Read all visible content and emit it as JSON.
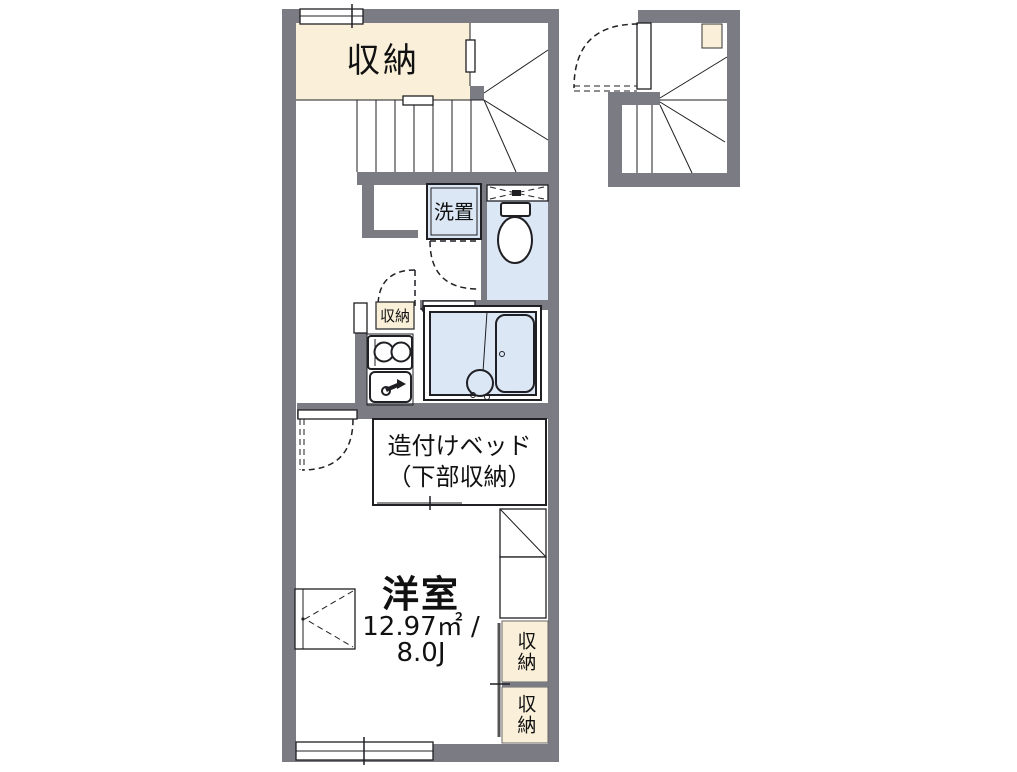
{
  "colors": {
    "wall": "#7b7b83",
    "cream": "#faf0da",
    "room_blue": "#dce7f5",
    "line": "#1f1f24",
    "text": "#111111"
  },
  "labels": {
    "closet_top": "収納",
    "washer": "洗置",
    "kitchen_storage": "収納",
    "bed_line1": "造付けベッド",
    "bed_line2": "（下部収納）",
    "room_name": "洋室",
    "room_area": "12.97㎡ /",
    "room_size": "8.0J",
    "storage_right_upper": "収納",
    "storage_right_lower": "収納"
  }
}
